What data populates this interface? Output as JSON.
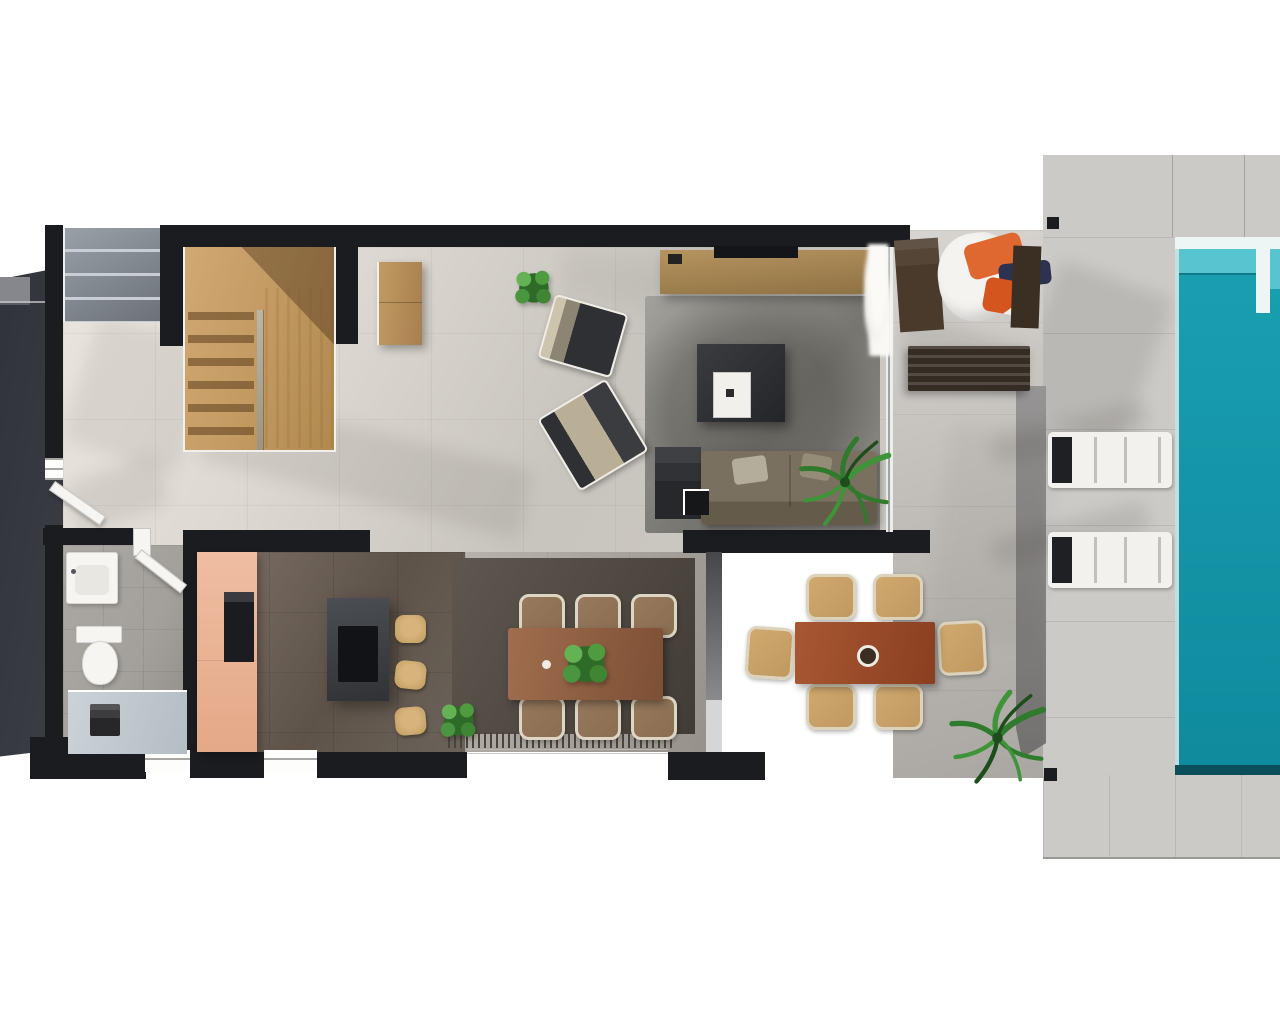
{
  "scene": {
    "kind": "3d-floor-plan-render",
    "view": "top-down",
    "description": "Top-down 3D render of a modern villa ground floor: timber staircase, entry hall, bathroom, kitchen with island, open-plan living and dining, covered terrace with lounge daybed and outdoor dining, sun deck with two loungers and a turquoise swimming pool on the right.",
    "rooms": [
      "staircase",
      "entry-hall",
      "bathroom",
      "kitchen",
      "living-room",
      "dining-area",
      "covered-terrace",
      "outdoor-dining",
      "pool-deck",
      "swimming-pool"
    ]
  },
  "inventory": {
    "staircase": "double-flight timber staircase with central divider",
    "living_room": [
      "tv-sideboard",
      "area-rug",
      "coffee-table-with-white-tray",
      "sofa-with-dark-side-unit",
      "armchair x2",
      "potted-plant",
      "palm-plant",
      "hall-console"
    ],
    "kitchen": [
      "peach-cabinet-column",
      "built-in-oven",
      "dark-island-with-cooktop",
      "bar-stool x3",
      "potted-plant"
    ],
    "dining": [
      "timber-table",
      "chair x6",
      "dark-fringed-rug",
      "plant-centerpiece"
    ],
    "terrace": [
      "daybed-with-cushions",
      "slatted-bench",
      "pampas-plant",
      "outdoor-table",
      "outdoor-chair x6",
      "palm-plant"
    ],
    "pool_area": [
      "sun-lounger x2",
      "pool-entry-step",
      "column-marker x2"
    ],
    "bathroom": [
      "washbasin",
      "toilet",
      "walk-in-shower",
      "swing-door"
    ],
    "entry": [
      "front-door",
      "entry-canopy-slats",
      "driveway-shadow"
    ]
  },
  "colors": {
    "wall": "#1b1c20",
    "floor_light": "#eae5de",
    "floor_mid": "#c8c4be",
    "floor_dark": "#cdc9c2",
    "dining_floor_a": "#b7b2ac",
    "dining_floor_b": "#96918b",
    "kitchen_a": "#7d7166",
    "kitchen_b": "#5e5349",
    "bath_floor": "#a39f9a",
    "stair_wood_a": "#d2a873",
    "stair_wood_b": "#b0894f",
    "peach_a": "#efbda1",
    "peach_b": "#e3a988",
    "island_a": "#4b4e53",
    "island_b": "#303236",
    "cooktop": "#121316",
    "stool": "#c9a469",
    "rug_living_a": "#a3a19c",
    "rug_living_b": "#77756f",
    "rug_dining_a": "#5e574f",
    "rug_dining_b": "#423c36",
    "fringe": "#4a443e",
    "table_wood_a": "#a06e4e",
    "table_wood_b": "#7d4f35",
    "outdoor_table_a": "#a85732",
    "outdoor_table_b": "#8a3f20",
    "chair_frame": "#ded6c4",
    "chair_seat": "#8a6e52",
    "outdoor_chair": "#bf9960",
    "sofa_a": "#7a7060",
    "sofa_b": "#655b4b",
    "tv_a": "#b6945f",
    "tv_b": "#8f7244",
    "coffee_a": "#3a3c40",
    "coffee_b": "#232528",
    "pool_water_a": "#1aa0b1",
    "pool_water_b": "#0f8a9d",
    "pool_light": "#58c4cf",
    "pool_coping": "#eef6f5",
    "pool_dark": "#0b4f5b",
    "deck": "#cbcac6",
    "deck_line": "#a3a29e",
    "terrace_a": "#d8d5d1",
    "terrace_b": "#aaa7a3",
    "dark_area_a": "#31333a",
    "dark_area_b": "#3c3e46",
    "slat_a": "#99a0a8",
    "slat_b": "#6c7179",
    "lounger": "#f2f1ed",
    "lounger_head": "#1f2023",
    "bench": "#352c24",
    "lounge_wood": "#4a3a2b",
    "pillow_orange": "#df6730",
    "pillow_orange2": "#d4551d",
    "pillow_navy": "#2d3250",
    "cushion_white": "#f4f3f0",
    "plant_a": "#64b253",
    "plant_b": "#4f9c40",
    "plant_c": "#3f8534",
    "plant_d": "#2e6b28",
    "palm_stroke": "#2f7a2c",
    "palm_stroke2": "#3f9338",
    "palm_dark": "#1e4d1c",
    "fixture_white": "#f6f5f2",
    "shower_a": "#ccd3d8",
    "shower_b": "#b4bdc4",
    "glass": "#d4d7d5",
    "drain": "#27272a"
  }
}
